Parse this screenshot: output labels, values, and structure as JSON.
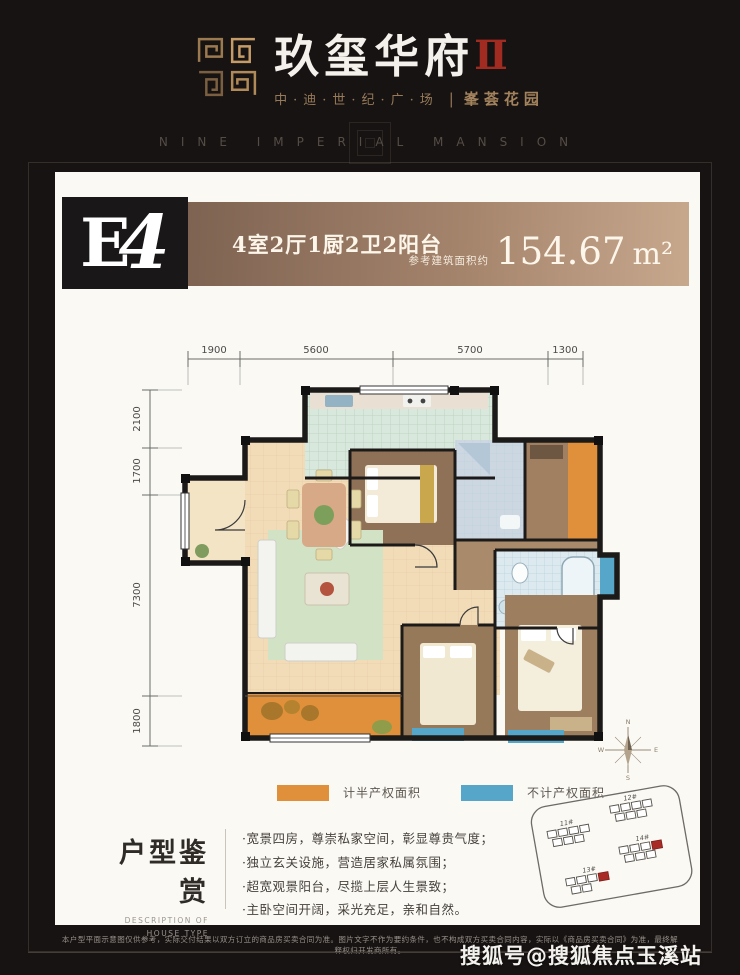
{
  "header": {
    "title": "玖玺华府",
    "title_suffix": "Ⅱ",
    "subtitle_left": "中·迪·世·纪·广·场",
    "subtitle_divider": "|",
    "subtitle_right": "峯荟花园",
    "tagline": "NINE IMPERIAL MANSION"
  },
  "unit_card": {
    "unit_code_letter": "E",
    "unit_code_number": "4",
    "unit_layout": "4室2厅1厨2卫2阳台",
    "area_prefix": "参考建筑面积约",
    "area_value": "154.67",
    "area_unit": "m²"
  },
  "floorplan": {
    "dims_top": [
      "1900",
      "5600",
      "5700",
      "1300"
    ],
    "dims_left": [
      "2100",
      "1700",
      "7300",
      "1800"
    ],
    "compass_points": {
      "n": "N",
      "e": "E",
      "s": "S",
      "w": "W"
    },
    "legend": [
      {
        "label": "计半产权面积",
        "color": "#e0903a"
      },
      {
        "label": "不计产权面积",
        "color": "#55a6c8"
      }
    ],
    "keyplan_buildings": [
      "11#",
      "12#",
      "13#",
      "14#"
    ]
  },
  "description": {
    "title": "户型鉴赏",
    "subtitle_line1": "DESCRIPTION OF",
    "subtitle_line2": "HOUSE TYPE",
    "bullets": [
      "·宽景四房，尊崇私家空间，彰显尊贵气度；",
      "·独立玄关设施，营造居家私属氛围；",
      "·超宽观景阳台，尽揽上层人生景致；",
      "·主卧空间开阔，采光充足，亲和自然。"
    ]
  },
  "footer": {
    "disclaimer": "本户型平面示意图仅供参考，实际交付结果以双方订立的商品房买卖合同为准。图片文字不作为要约条件，也不构成双方买卖合同内容，实际以《商品房买卖合同》为准，最终解释权归开发商所有。",
    "watermark": "搜狐号@搜狐焦点玉溪站"
  },
  "colors": {
    "accent_red": "#a12b20",
    "bronze": "#a3835d",
    "half_area_orange": "#e0903a",
    "no_count_blue": "#55a6c8"
  }
}
